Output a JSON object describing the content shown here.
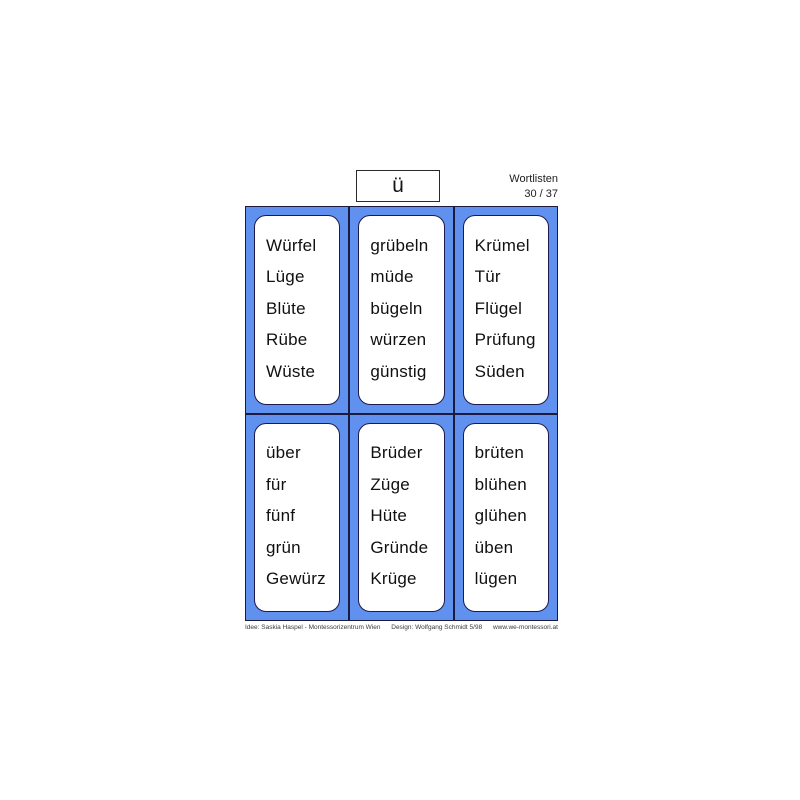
{
  "header": {
    "letter": "ü",
    "title": "Wortlisten",
    "page": "30 / 37"
  },
  "cards": [
    {
      "words": [
        "Würfel",
        "Lüge",
        "Blüte",
        "Rübe",
        "Wüste"
      ]
    },
    {
      "words": [
        "grübeln",
        "müde",
        "bügeln",
        "würzen",
        "günstig"
      ]
    },
    {
      "words": [
        "Krümel",
        "Tür",
        "Flügel",
        "Prüfung",
        "Süden"
      ]
    },
    {
      "words": [
        "über",
        "für",
        "fünf",
        "grün",
        "Gewürz"
      ]
    },
    {
      "words": [
        "Brüder",
        "Züge",
        "Hüte",
        "Gründe",
        "Krüge"
      ]
    },
    {
      "words": [
        "brüten",
        "blühen",
        "glühen",
        "üben",
        "lügen"
      ]
    }
  ],
  "footer": {
    "idea": "Idee: Saskia Haspel - Montessorizentrum Wien",
    "design": "Design: Wolfgang Schmidt 5/98",
    "website": "www.we-montessori.at"
  },
  "colors": {
    "cell_background": "#6191ef",
    "cell_border": "#1b1b40",
    "card_background": "#ffffff",
    "card_border": "#1b1b50",
    "text": "#101010"
  }
}
